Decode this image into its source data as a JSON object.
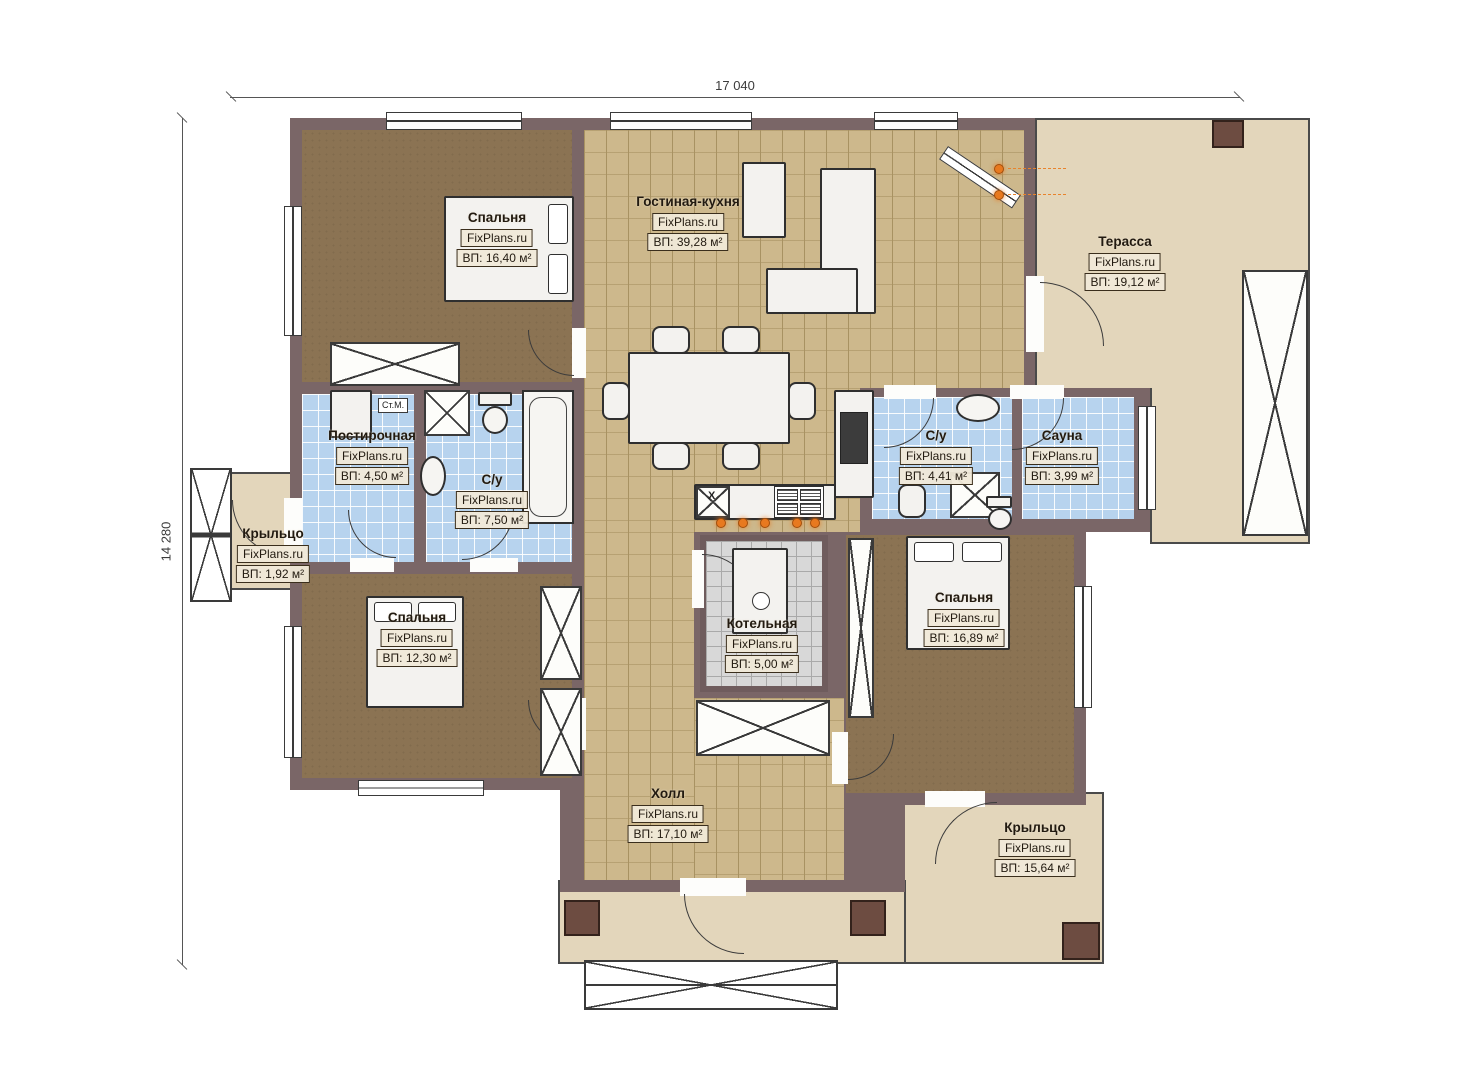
{
  "brand": "FixPlans.ru",
  "dimensions": {
    "width": "17 040",
    "height": "14 280"
  },
  "rooms": [
    {
      "id": "bedroom-1",
      "name": "Спальня",
      "area": "ВП: 16,40 м²"
    },
    {
      "id": "living-kitchen",
      "name": "Гостиная-кухня",
      "area": "ВП: 39,28 м²"
    },
    {
      "id": "terrace",
      "name": "Терасса",
      "area": "ВП: 19,12 м²"
    },
    {
      "id": "laundry",
      "name": "Постирочная",
      "area": "ВП: 4,50 м²"
    },
    {
      "id": "bathroom-1",
      "name": "С/у",
      "area": "ВП: 7,50 м²"
    },
    {
      "id": "porch-left",
      "name": "Крыльцо",
      "area": "ВП: 1,92 м²"
    },
    {
      "id": "bathroom-2",
      "name": "С/у",
      "area": "ВП: 4,41 м²"
    },
    {
      "id": "sauna",
      "name": "Сауна",
      "area": "ВП: 3,99 м²"
    },
    {
      "id": "bedroom-2",
      "name": "Спальня",
      "area": "ВП: 12,30 м²"
    },
    {
      "id": "boiler-room",
      "name": "Котельная",
      "area": "ВП: 5,00 м²"
    },
    {
      "id": "bedroom-3",
      "name": "Спальня",
      "area": "ВП: 16,89 м²"
    },
    {
      "id": "hall",
      "name": "Холл",
      "area": "ВП: 17,10 м²"
    },
    {
      "id": "porch-right",
      "name": "Крыльцо",
      "area": "ВП: 15,64 м²"
    }
  ],
  "annotations": {
    "washing_machine": "Ст.М.",
    "sink_mark": "X"
  },
  "colors": {
    "wall": "#7a6667",
    "wood_floor": "#8b7353",
    "tile_tan": "#cdb88c",
    "tile_blue": "#b7d3ee",
    "tile_gray": "#d8d8d8",
    "slab": "#e3d6bb",
    "accent_orange": "#e8791f",
    "column": "#6d4c41"
  }
}
